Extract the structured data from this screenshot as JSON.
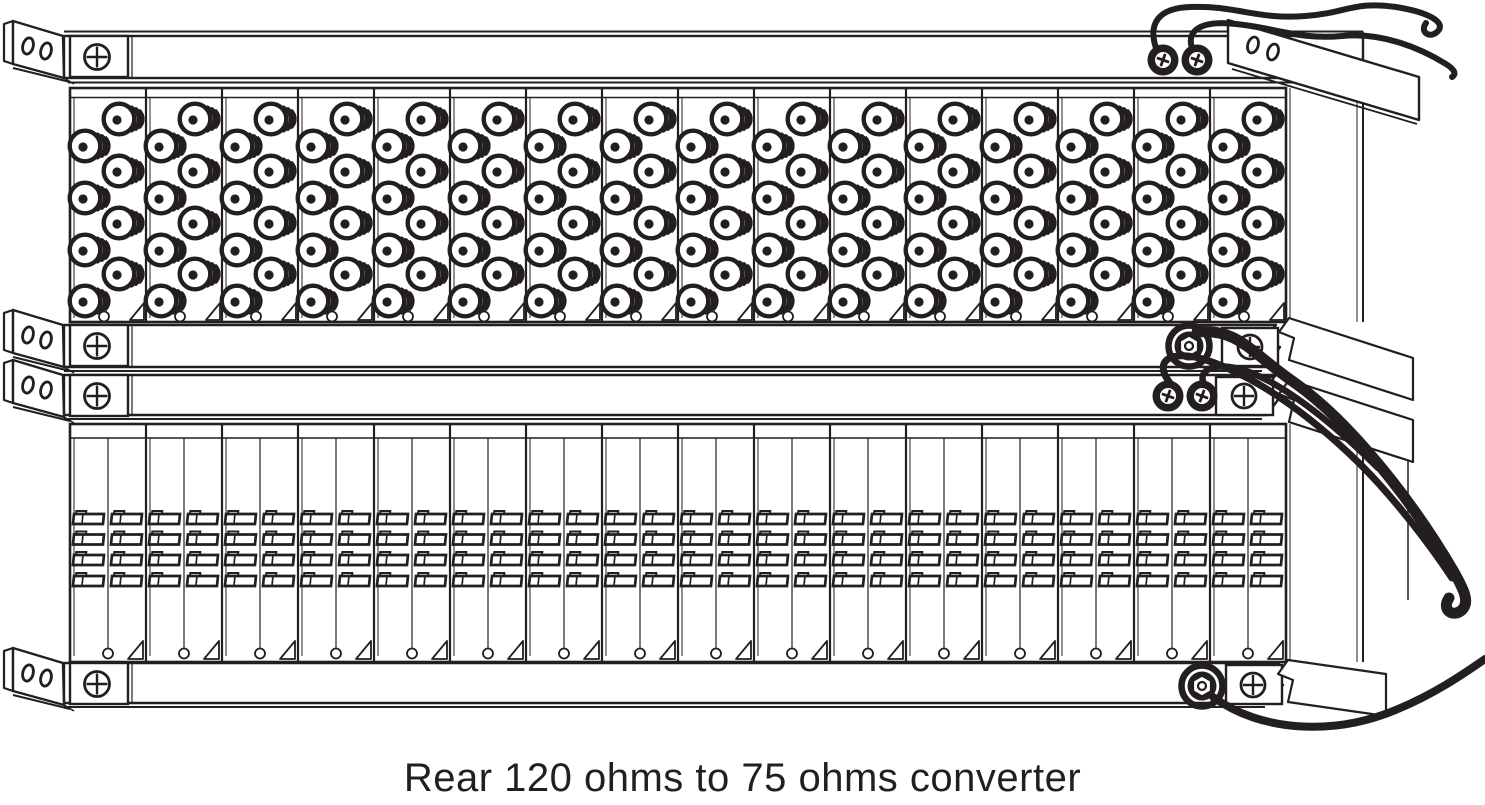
{
  "caption": "Rear 120 ohms to 75 ohms converter",
  "colors": {
    "ink": "#231f20",
    "background": "#ffffff"
  },
  "diagram": {
    "top_panel": {
      "cards": 16,
      "connector_columns_per_card": 2,
      "connector_rows_per_column": 4,
      "coax_connectors_per_card": 8,
      "card_screw_holes": 16
    },
    "bottom_panel": {
      "cards": 16,
      "terminal_rows": 4,
      "terminal_blocks_per_card_per_row": 2,
      "terminal_blocks_per_row": 32,
      "card_screw_holes": 16
    },
    "left_mount_ears": {
      "count": 4,
      "oval_holes_each": 2,
      "phillips_screws_each": 1
    },
    "right_mount_ears": {
      "count": 4,
      "oval_holes_on_top_ear": 2
    },
    "right_plate_phillips_screws": 3,
    "ground_ring_terminals": 4,
    "hex_nuts_with_wire": 2,
    "ground_wires": 6,
    "icons": [
      "coax-connector",
      "terminal-block",
      "phillips-screw-icon",
      "ring-terminal-icon",
      "hex-nut-icon",
      "oval-hole",
      "ground-wire"
    ]
  }
}
